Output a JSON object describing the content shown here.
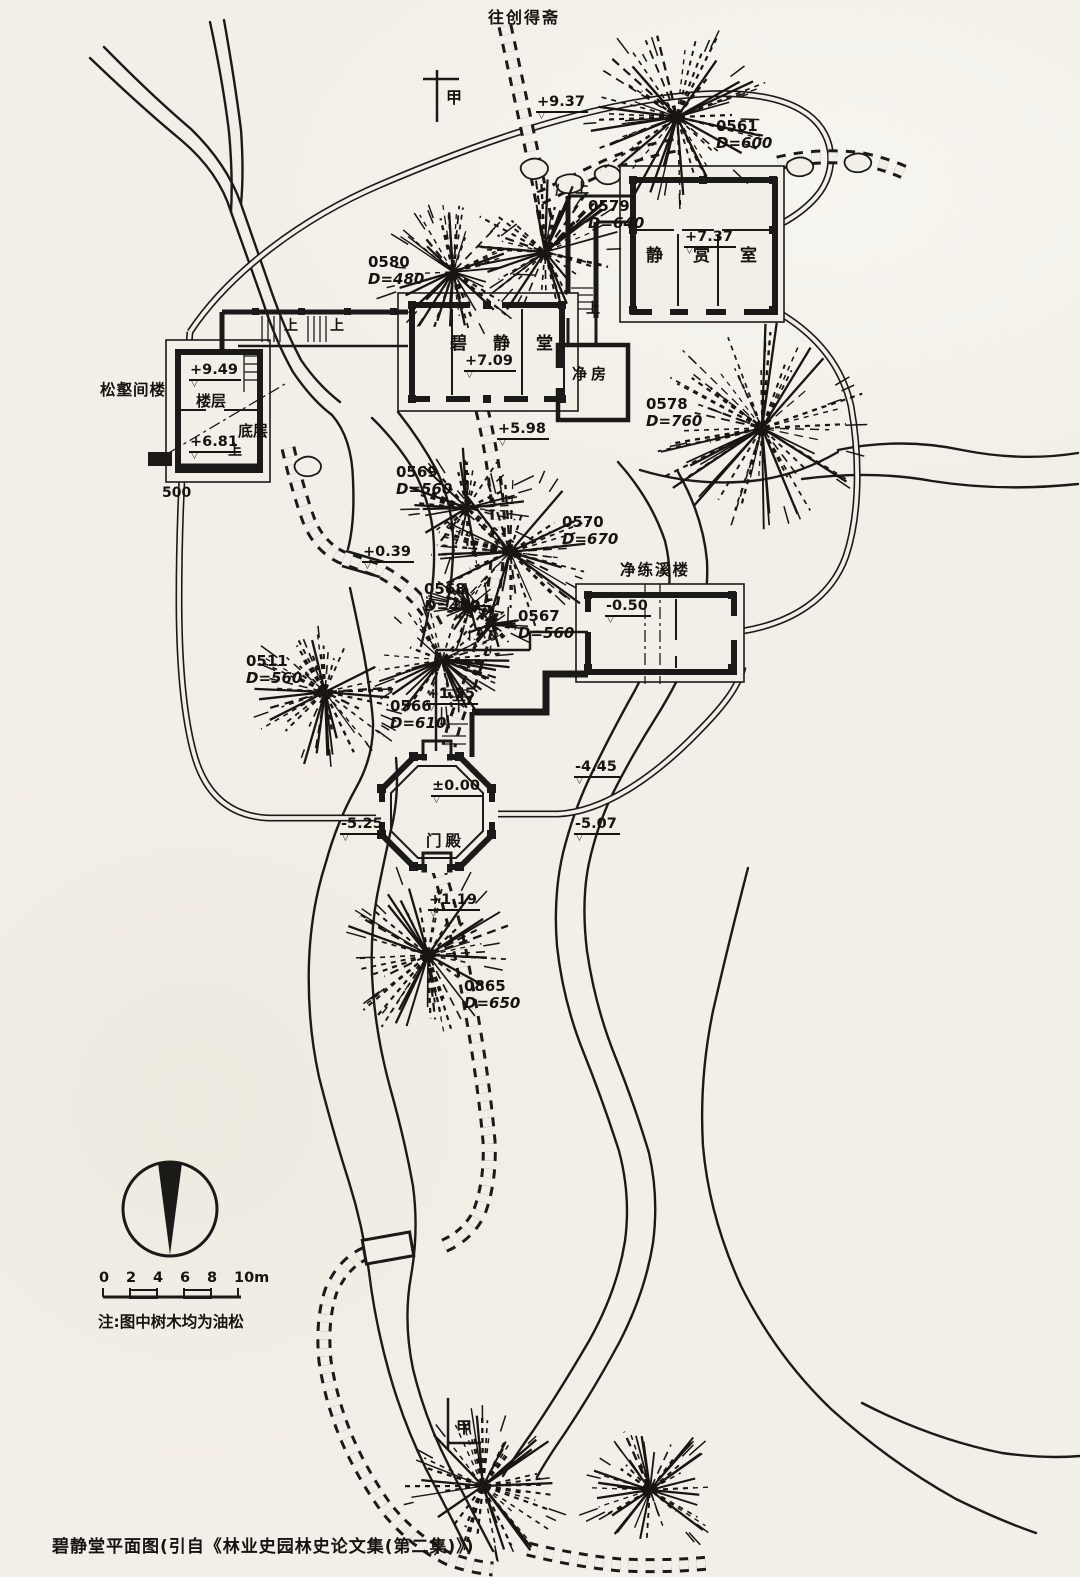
{
  "page": {
    "caption": "碧静堂平面图(引自《林业史园林史论文集(第二集)》)",
    "note": "注:图中树木均为油松"
  },
  "route_label": {
    "text": "往创得斋"
  },
  "contour_label": {
    "text": "500"
  },
  "compass": {
    "icon": "north-arrow"
  },
  "scale_bar": {
    "ticks": [
      "0",
      "2",
      "4",
      "6",
      "8",
      "10m"
    ]
  },
  "section_markers": [
    {
      "text": "甲",
      "x": 446,
      "y": 84
    },
    {
      "text": "甲",
      "x": 456,
      "y": 1414
    }
  ],
  "buildings": {
    "jing_shang_shi": {
      "name": "静赏室"
    },
    "bi_jing_tang": {
      "name": "碧静堂"
    },
    "jing_fang": {
      "name": "净房"
    },
    "song_he_jian_lou": {
      "name": "松壑间楼"
    },
    "lou_ceng": {
      "name": "楼层"
    },
    "di_ceng": {
      "name": "底层"
    },
    "jing_lian_xi_lou": {
      "name": "净练溪楼"
    },
    "men_dian": {
      "name": "门殿"
    }
  },
  "stair_labels": [
    {
      "t": "上",
      "x": 284,
      "y": 315
    },
    {
      "t": "上",
      "x": 330,
      "y": 315
    },
    {
      "t": "上",
      "x": 575,
      "y": 178
    },
    {
      "t": "上",
      "x": 586,
      "y": 298
    },
    {
      "t": "上",
      "x": 228,
      "y": 440
    },
    {
      "t": "下",
      "x": 452,
      "y": 696
    }
  ],
  "elevation_markers": [
    {
      "value": "+9.37",
      "x": 536,
      "y": 94
    },
    {
      "value": "+7.37",
      "x": 684,
      "y": 229
    },
    {
      "value": "+7.09",
      "x": 464,
      "y": 353
    },
    {
      "value": "+9.49",
      "x": 189,
      "y": 362
    },
    {
      "value": "+6.81",
      "x": 189,
      "y": 434
    },
    {
      "value": "+5.98",
      "x": 497,
      "y": 421
    },
    {
      "value": "+0.39",
      "x": 362,
      "y": 544
    },
    {
      "value": "-0.50",
      "x": 605,
      "y": 598
    },
    {
      "value": "+1.55",
      "x": 426,
      "y": 686
    },
    {
      "value": "±0.00",
      "x": 431,
      "y": 778
    },
    {
      "value": "-5.25",
      "x": 340,
      "y": 816
    },
    {
      "value": "-4.45",
      "x": 574,
      "y": 759
    },
    {
      "value": "-5.07",
      "x": 574,
      "y": 816
    },
    {
      "value": "+1.19",
      "x": 428,
      "y": 892
    }
  ],
  "trees": [
    {
      "id": "0561",
      "dia": "D=600",
      "cx": 677,
      "cy": 117,
      "r": 95,
      "lx": 716,
      "ly": 118
    },
    {
      "id": "0579",
      "dia": "D=640",
      "cx": 545,
      "cy": 252,
      "r": 78,
      "lx": 588,
      "ly": 198
    },
    {
      "id": "0580",
      "dia": "D=480",
      "cx": 453,
      "cy": 272,
      "r": 70,
      "lx": 368,
      "ly": 254
    },
    {
      "id": "0578",
      "dia": "D=760",
      "cx": 762,
      "cy": 428,
      "r": 112,
      "lx": 646,
      "ly": 396
    },
    {
      "id": "0569",
      "dia": "D=560",
      "cx": 467,
      "cy": 508,
      "r": 62,
      "lx": 396,
      "ly": 464
    },
    {
      "id": "0570",
      "dia": "D=670",
      "cx": 510,
      "cy": 552,
      "r": 88,
      "lx": 562,
      "ly": 514
    },
    {
      "id": "0568",
      "dia": "D=460",
      "cx": 470,
      "cy": 606,
      "r": 30,
      "lx": 424,
      "ly": 581
    },
    {
      "id": "0567",
      "dia": "D=560",
      "cx": 492,
      "cy": 624,
      "r": 26,
      "lx": 518,
      "ly": 608
    },
    {
      "id": "0511",
      "dia": "D=560",
      "cx": 325,
      "cy": 692,
      "r": 76,
      "lx": 246,
      "ly": 653
    },
    {
      "id": "0566",
      "dia": "D=610",
      "cx": 442,
      "cy": 660,
      "r": 68,
      "lx": 390,
      "ly": 698
    },
    {
      "id": "0865",
      "dia": "D=650",
      "cx": 428,
      "cy": 955,
      "r": 86,
      "lx": 464,
      "ly": 978
    },
    {
      "id": "",
      "dia": "",
      "cx": 483,
      "cy": 1486,
      "r": 82,
      "lx": 0,
      "ly": 0
    },
    {
      "id": "",
      "dia": "",
      "cx": 650,
      "cy": 1490,
      "r": 68,
      "lx": 0,
      "ly": 0
    }
  ]
}
